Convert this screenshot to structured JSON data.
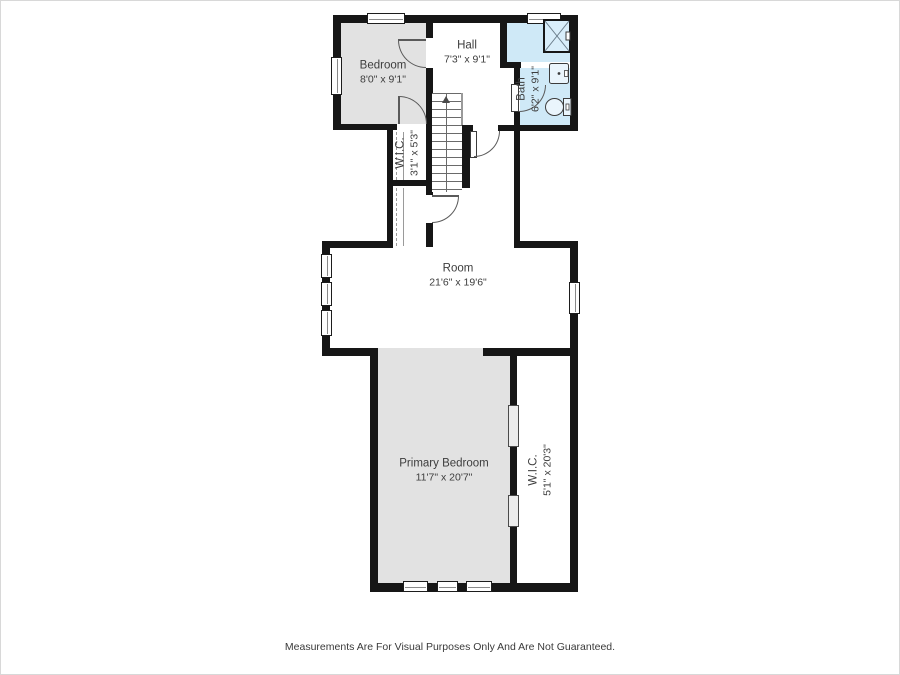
{
  "plan": {
    "rooms": {
      "bedroom": {
        "name": "Bedroom",
        "dims": "8'0\" x 9'1\""
      },
      "hall": {
        "name": "Hall",
        "dims": "7'3\" x 9'1\""
      },
      "bath": {
        "name": "Bath",
        "dims": "6'2\" x 9'1\""
      },
      "wic_upper": {
        "name": "W.I.C.",
        "dims": "3'1\" x 5'3\""
      },
      "room": {
        "name": "Room",
        "dims": "21'6\" x 19'6\""
      },
      "primary_bedroom": {
        "name": "Primary Bedroom",
        "dims": "11'7\" x 20'7\""
      },
      "wic_primary": {
        "name": "W.I.C.",
        "dims": "5'1\" x 20'3\""
      }
    },
    "colors": {
      "wall": "#161616",
      "room_gray": "#e2e2e2",
      "bath_blue": "#cfe9f7",
      "line": "#5a5a5a",
      "text": "#3d3d3d"
    }
  },
  "footer": {
    "disclaimer": "Measurements Are For Visual Purposes Only And Are Not Guaranteed."
  }
}
